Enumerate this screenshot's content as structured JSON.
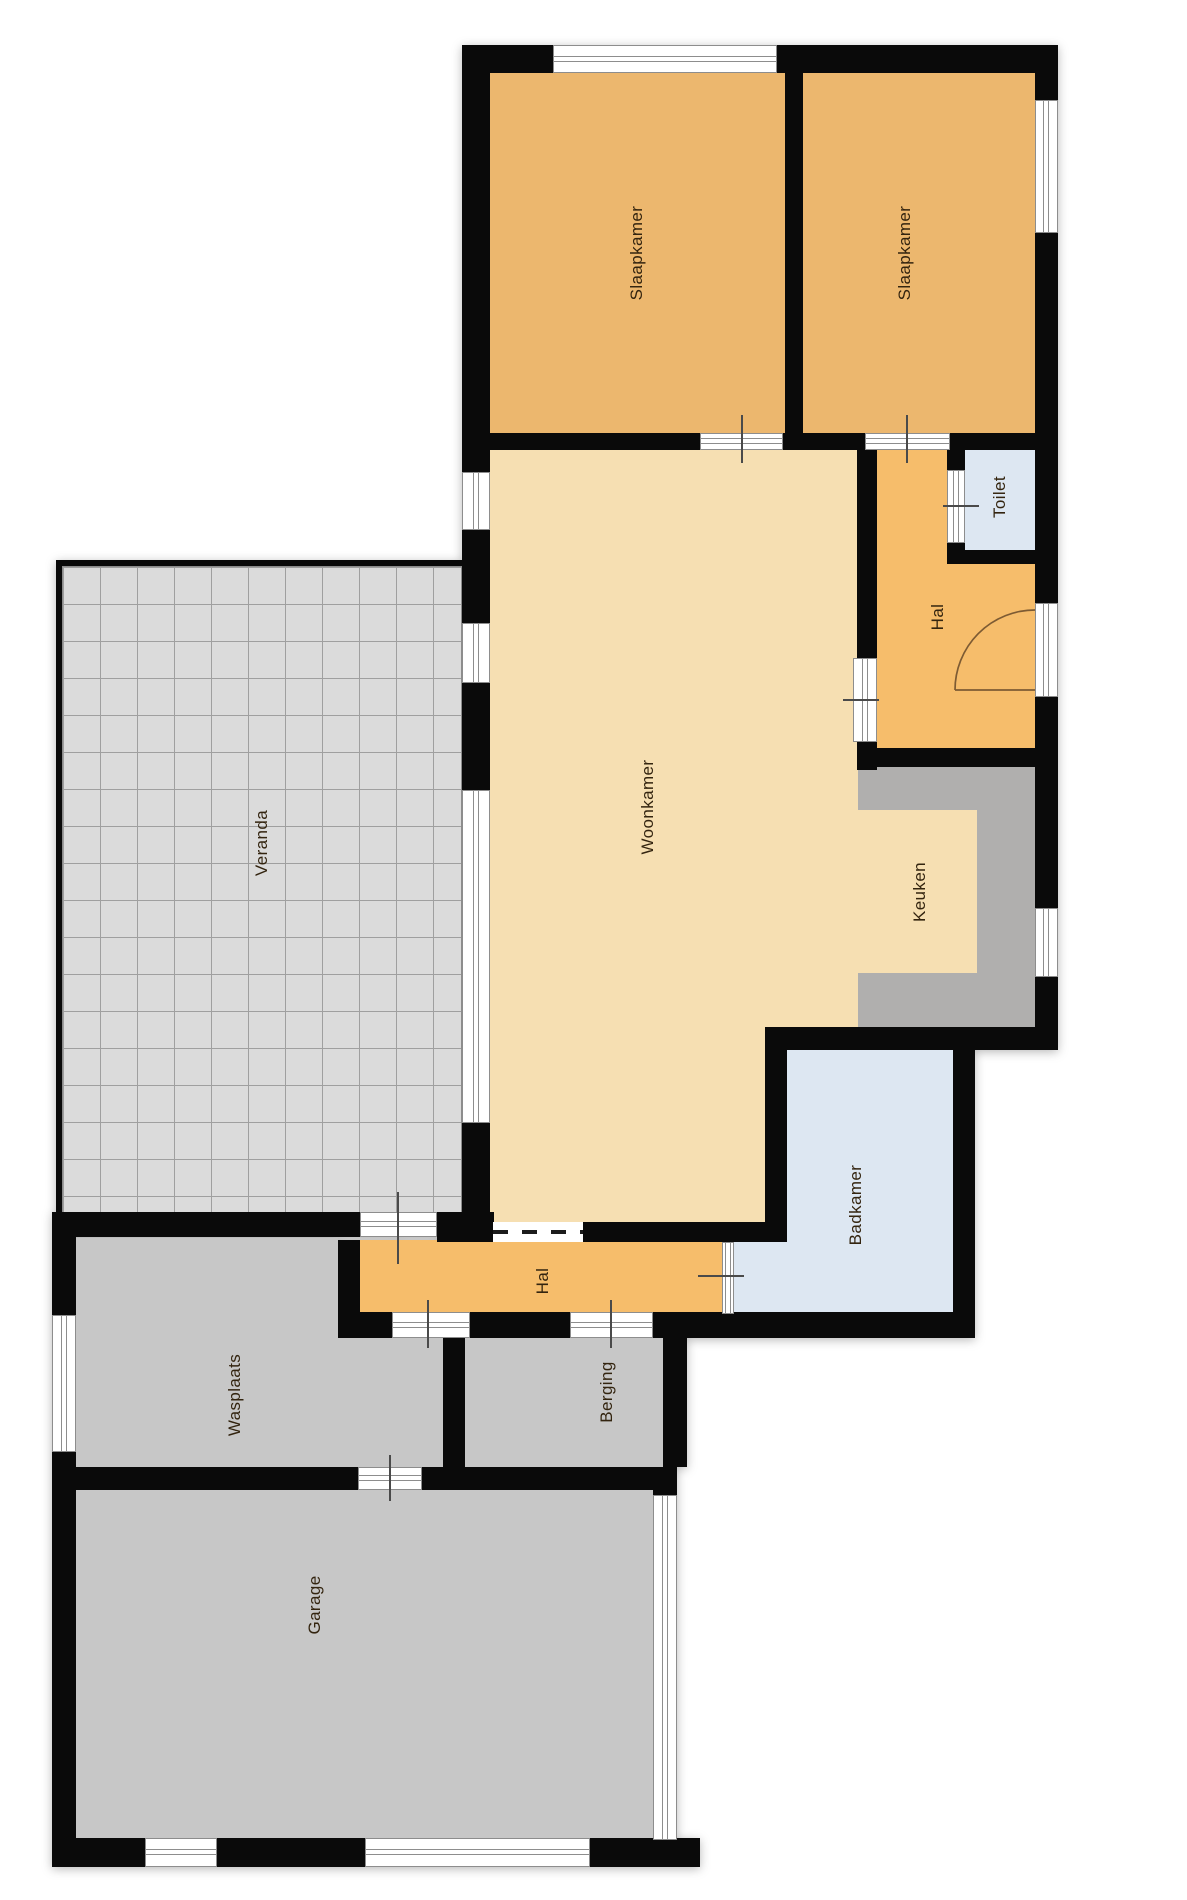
{
  "colors": {
    "wall": "#0a0a0a",
    "bedroom": "#ecb76e",
    "hall": "#f6bd6b",
    "living": "#f6dfb2",
    "bath": "#dde7f2",
    "counter": "#b0afae",
    "utility": "#c7c7c7",
    "veranda_bg": "#dbdbdb",
    "veranda_line": "#9f9f9f",
    "window_frame": "#8d8d8d",
    "tick": "#4a4a4a",
    "door_arc": "#7d5b33",
    "label_text": "#33240f"
  },
  "plan": {
    "width": 1187,
    "height": 1900,
    "front_door_arc": "M 955 690 L 1035 690 M 955 690 A 80 80 0 0 1 1035 610",
    "rooms": [
      {
        "id": "woonkamer",
        "label": "Woonkamer",
        "fill": "living",
        "label_cx": 648,
        "label_cy": 807,
        "rects": [
          [
            486,
            440,
            390,
            802
          ]
        ]
      },
      {
        "id": "keuken",
        "label": "Keuken",
        "fill": "living",
        "label_cx": 920,
        "label_cy": 892,
        "rects": [
          [
            858,
            805,
            122,
            170
          ]
        ]
      },
      {
        "id": "keuken-aanrecht",
        "label": "",
        "fill": "counter",
        "rects": [
          [
            858,
            765,
            177,
            45
          ],
          [
            977,
            805,
            58,
            170
          ],
          [
            858,
            973,
            177,
            55
          ]
        ]
      },
      {
        "id": "badkamer",
        "label": "Badkamer",
        "fill": "bath",
        "label_cx": 856,
        "label_cy": 1205,
        "rects": [
          [
            787,
            1048,
            166,
            194
          ],
          [
            727,
            1240,
            226,
            74
          ]
        ]
      },
      {
        "id": "hal-boven",
        "label": "Hal",
        "fill": "hall",
        "label_cx": 938,
        "label_cy": 617,
        "rects": [
          [
            872,
            437,
            170,
            318
          ]
        ]
      },
      {
        "id": "toilet",
        "label": "Toilet",
        "fill": "bath",
        "label_cx": 1000,
        "label_cy": 497,
        "rects": [
          [
            950,
            440,
            90,
            118
          ]
        ]
      },
      {
        "id": "slaapkamer-1",
        "label": "Slaapkamer",
        "fill": "bedroom",
        "label_cx": 637,
        "label_cy": 253,
        "rects": [
          [
            486,
            70,
            302,
            368
          ]
        ]
      },
      {
        "id": "slaapkamer-2",
        "label": "Slaapkamer",
        "fill": "bedroom",
        "label_cx": 905,
        "label_cy": 253,
        "rects": [
          [
            800,
            70,
            245,
            368
          ]
        ]
      },
      {
        "id": "hal-beneden",
        "label": "Hal",
        "fill": "hall",
        "label_cx": 543,
        "label_cy": 1281,
        "rects": [
          [
            356,
            1240,
            368,
            74
          ]
        ]
      },
      {
        "id": "wasplaats",
        "label": "Wasplaats",
        "fill": "utility",
        "label_cx": 235,
        "label_cy": 1395,
        "rects": [
          [
            76,
            1238,
            262,
            102
          ],
          [
            76,
            1338,
            367,
            130
          ]
        ]
      },
      {
        "id": "berging",
        "label": "Berging",
        "fill": "utility",
        "label_cx": 607,
        "label_cy": 1392,
        "rects": [
          [
            465,
            1338,
            198,
            130
          ]
        ]
      },
      {
        "id": "garage",
        "label": "Garage",
        "fill": "utility",
        "label_cx": 315,
        "label_cy": 1605,
        "rects": [
          [
            76,
            1490,
            577,
            350
          ]
        ]
      },
      {
        "id": "veranda",
        "label": "Veranda",
        "fill": "veranda_bg",
        "grid": true,
        "label_cx": 262,
        "label_cy": 843,
        "rects": [
          [
            62,
            566,
            400,
            649
          ]
        ]
      }
    ],
    "walls": [
      [
        462,
        45,
        596,
        28
      ],
      [
        462,
        45,
        28,
        427
      ],
      [
        462,
        530,
        28,
        93
      ],
      [
        462,
        683,
        28,
        107
      ],
      [
        462,
        1123,
        28,
        119
      ],
      [
        1035,
        45,
        23,
        55
      ],
      [
        1035,
        233,
        23,
        370
      ],
      [
        1035,
        697,
        23,
        211
      ],
      [
        1035,
        977,
        23,
        73
      ],
      [
        785,
        70,
        18,
        368
      ],
      [
        462,
        433,
        238,
        17
      ],
      [
        783,
        433,
        82,
        17
      ],
      [
        950,
        433,
        108,
        17
      ],
      [
        857,
        437,
        20,
        223
      ],
      [
        857,
        737,
        20,
        33
      ],
      [
        947,
        448,
        18,
        24
      ],
      [
        947,
        541,
        18,
        23
      ],
      [
        947,
        550,
        88,
        14
      ],
      [
        857,
        748,
        178,
        19
      ],
      [
        765,
        1027,
        293,
        23
      ],
      [
        765,
        1027,
        22,
        215
      ],
      [
        953,
        1027,
        22,
        310
      ],
      [
        462,
        1222,
        32,
        20
      ],
      [
        583,
        1222,
        204,
        20
      ],
      [
        52,
        1212,
        308,
        25
      ],
      [
        437,
        1212,
        57,
        30
      ],
      [
        338,
        1240,
        22,
        88
      ],
      [
        338,
        1312,
        54,
        26
      ],
      [
        470,
        1312,
        100,
        26
      ],
      [
        653,
        1312,
        322,
        26
      ],
      [
        52,
        1212,
        24,
        106
      ],
      [
        52,
        1450,
        24,
        417
      ],
      [
        443,
        1338,
        22,
        130
      ],
      [
        663,
        1312,
        24,
        155
      ],
      [
        52,
        1467,
        306,
        23
      ],
      [
        422,
        1467,
        255,
        23
      ],
      [
        653,
        1467,
        24,
        30
      ],
      [
        52,
        1838,
        93,
        29
      ],
      [
        217,
        1838,
        148,
        29
      ],
      [
        590,
        1838,
        110,
        29
      ],
      [
        56,
        560,
        6,
        656
      ],
      [
        56,
        560,
        406,
        6
      ]
    ],
    "openings": [
      {
        "rect": [
          553,
          45,
          224,
          28
        ],
        "orient": "h",
        "kind": "window-slaapkamer-top"
      },
      {
        "rect": [
          1035,
          100,
          23,
          133
        ],
        "orient": "v",
        "kind": "window-slaapkamer-right"
      },
      {
        "rect": [
          1035,
          603,
          23,
          94
        ],
        "orient": "v",
        "kind": "front-door"
      },
      {
        "rect": [
          1035,
          908,
          23,
          69
        ],
        "orient": "v",
        "kind": "window-keuken"
      },
      {
        "rect": [
          462,
          472,
          28,
          58
        ],
        "orient": "v",
        "kind": "window-woonkamer-1"
      },
      {
        "rect": [
          462,
          623,
          28,
          60
        ],
        "orient": "v",
        "kind": "window-woonkamer-2"
      },
      {
        "rect": [
          462,
          790,
          28,
          333
        ],
        "orient": "v",
        "kind": "window-woonkamer-slider"
      },
      {
        "rect": [
          853,
          658,
          24,
          84
        ],
        "orient": "v",
        "kind": "opening-woonkamer-hal"
      },
      {
        "rect": [
          947,
          470,
          18,
          73
        ],
        "orient": "v",
        "kind": "door-toilet"
      },
      {
        "rect": [
          700,
          433,
          83,
          17
        ],
        "orient": "h",
        "kind": "door-slaapkamer-1"
      },
      {
        "rect": [
          865,
          433,
          85,
          17
        ],
        "orient": "h",
        "kind": "door-slaapkamer-2"
      },
      {
        "rect": [
          360,
          1212,
          77,
          25
        ],
        "orient": "h",
        "kind": "door-veranda-hal"
      },
      {
        "rect": [
          493,
          1222,
          90,
          20
        ],
        "orient": "h",
        "style": "dashed",
        "kind": "sliding-door-woonkamer-hal"
      },
      {
        "rect": [
          392,
          1312,
          78,
          26
        ],
        "orient": "h",
        "kind": "door-hal-wasplaats"
      },
      {
        "rect": [
          570,
          1312,
          83,
          26
        ],
        "orient": "h",
        "kind": "door-hal-berging"
      },
      {
        "rect": [
          722,
          1242,
          12,
          72
        ],
        "orient": "v",
        "kind": "door-hal-badkamer"
      },
      {
        "rect": [
          358,
          1467,
          64,
          23
        ],
        "orient": "h",
        "kind": "door-wasplaats-garage"
      },
      {
        "rect": [
          52,
          1315,
          24,
          137
        ],
        "orient": "v",
        "kind": "window-wasplaats"
      },
      {
        "rect": [
          653,
          1495,
          24,
          345
        ],
        "orient": "v",
        "kind": "window-garage-right"
      },
      {
        "rect": [
          145,
          1838,
          72,
          29
        ],
        "orient": "h",
        "kind": "window-garage-1"
      },
      {
        "rect": [
          365,
          1838,
          225,
          29
        ],
        "orient": "h",
        "kind": "window-garage-2"
      }
    ],
    "ticks": [
      [
        741,
        415,
        48,
        "v"
      ],
      [
        906,
        415,
        48,
        "v"
      ],
      [
        943,
        505,
        36,
        "h"
      ],
      [
        843,
        699,
        36,
        "h"
      ],
      [
        397,
        1192,
        72,
        "v"
      ],
      [
        427,
        1300,
        48,
        "v"
      ],
      [
        610,
        1300,
        48,
        "v"
      ],
      [
        698,
        1275,
        46,
        "h"
      ],
      [
        389,
        1455,
        46,
        "v"
      ]
    ]
  }
}
